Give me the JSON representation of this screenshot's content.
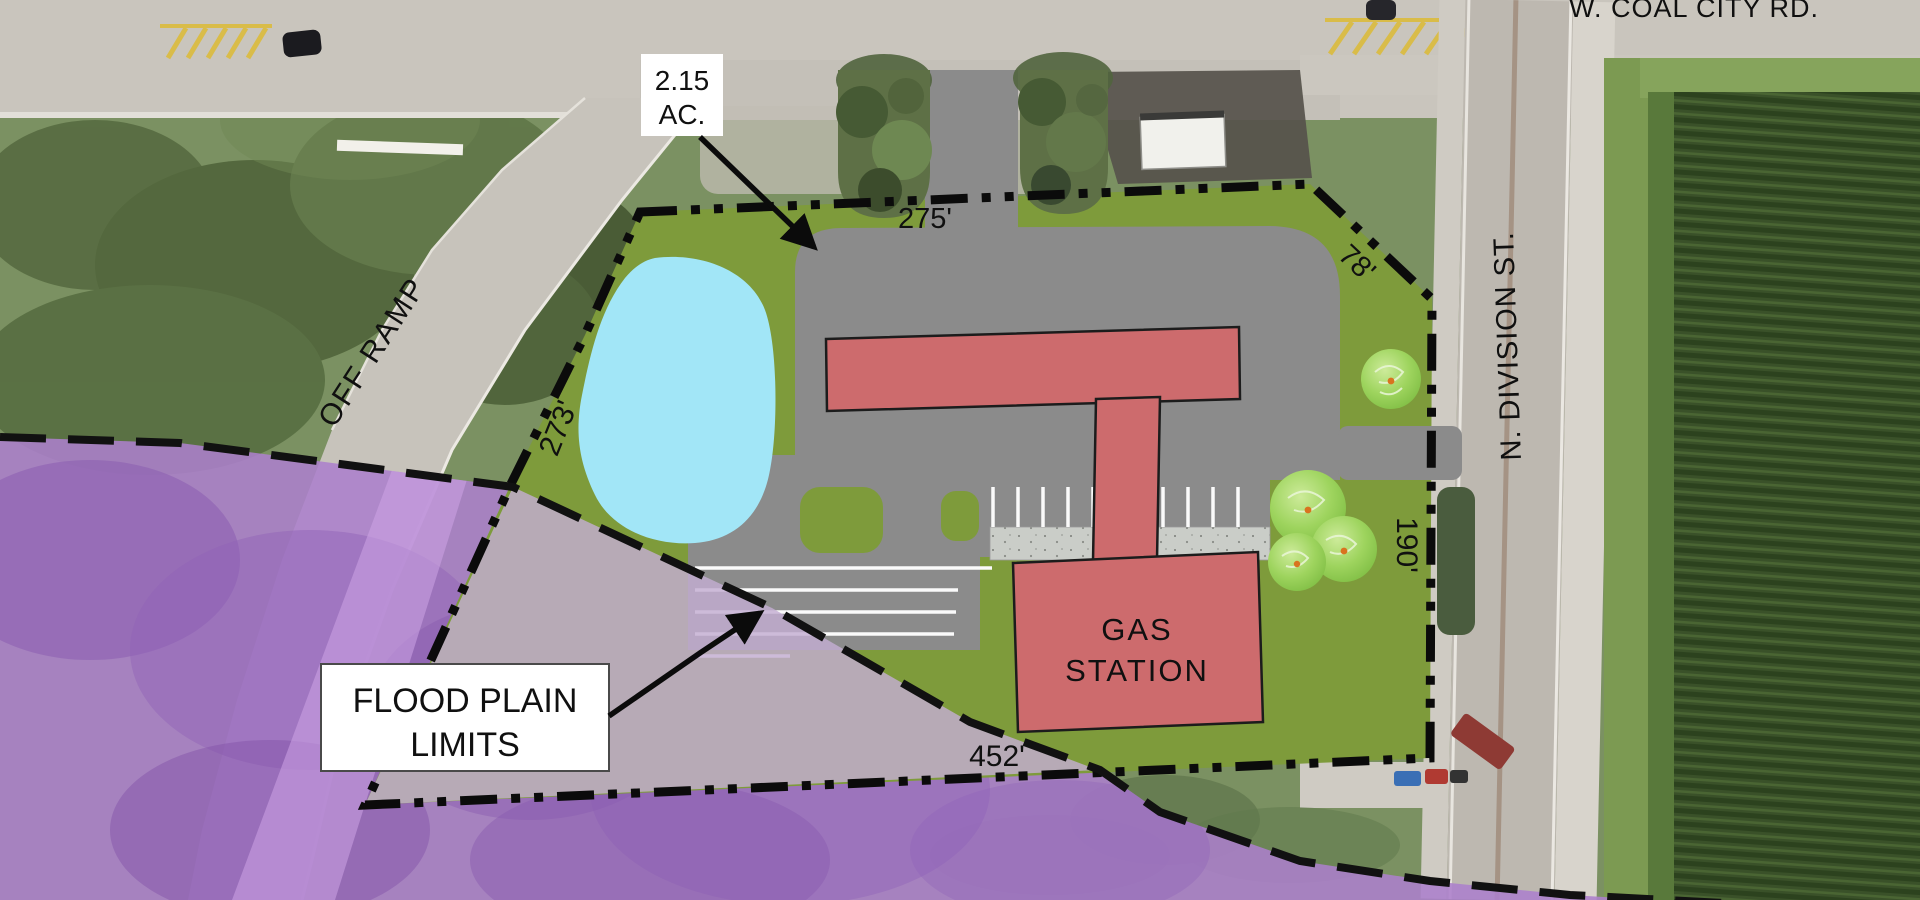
{
  "plan": {
    "roads": {
      "top_road": "W. COAL CITY RD.",
      "right_road": "N. DIVISION ST.",
      "ramp": "OFF RAMP"
    },
    "area_label": {
      "line1": "2.15",
      "line2": "AC."
    },
    "flood_label": {
      "line1": "FLOOD PLAIN",
      "line2": "LIMITS"
    },
    "building_label": {
      "line1": "GAS",
      "line2": "STATION"
    },
    "dimensions": {
      "north": "275'",
      "northeast": "78'",
      "west": "273'",
      "east": "190'",
      "south": "452'"
    },
    "colors": {
      "site_green": "#7E9B3B",
      "pavement_gray": "#8B8B8B",
      "pond_blue": "#A2E6F7",
      "building_red": "#CD6B6D",
      "flood_deep_purple": "#AC7FCC",
      "flood_light_purple": "#C3ADD2",
      "concrete": "#CACDC8",
      "boundary_black": "#0B0B0B",
      "tree_green": "#9ED45E"
    }
  }
}
